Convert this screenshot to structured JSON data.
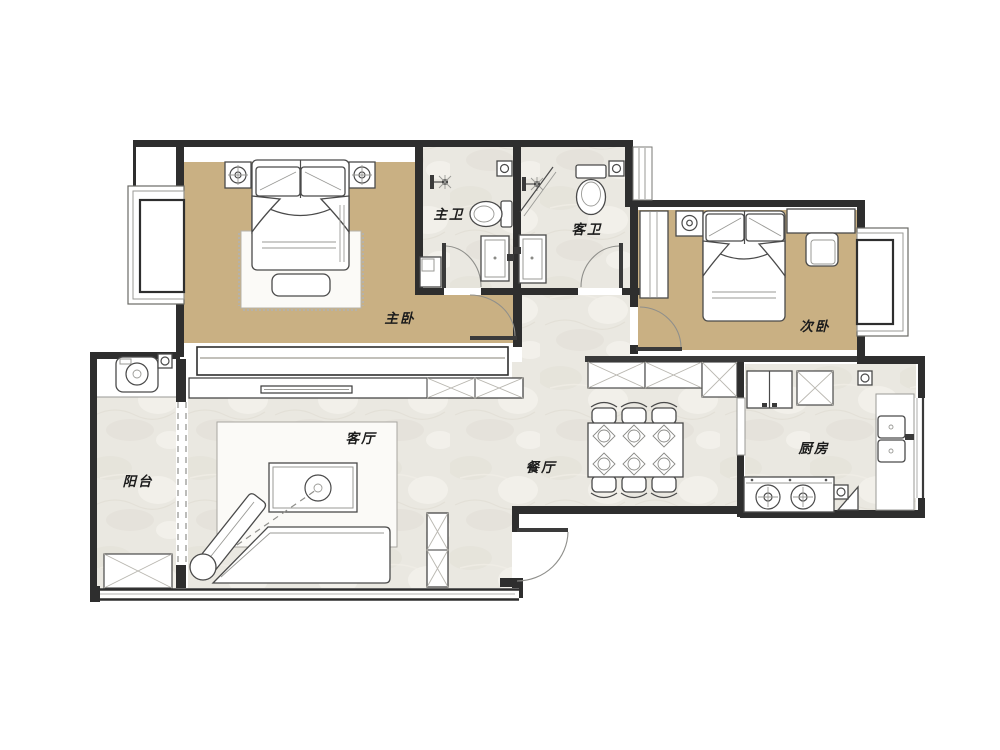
{
  "rooms": {
    "master_bedroom": {
      "label": "主卧"
    },
    "second_bedroom": {
      "label": "次卧"
    },
    "master_bath": {
      "label": "主卫"
    },
    "guest_bath": {
      "label": "客卫"
    },
    "living_room": {
      "label": "客厅"
    },
    "dining_room": {
      "label": "餐厅"
    },
    "kitchen": {
      "label": "厨房"
    },
    "balcony": {
      "label": "阳台"
    }
  },
  "colors": {
    "wall": "#2E2E2E",
    "bedroom_floor": "#C9B083",
    "marble_floor": "#E9E7E0",
    "furniture_line": "#4A4A4A",
    "rug": "#FBFAF7"
  }
}
